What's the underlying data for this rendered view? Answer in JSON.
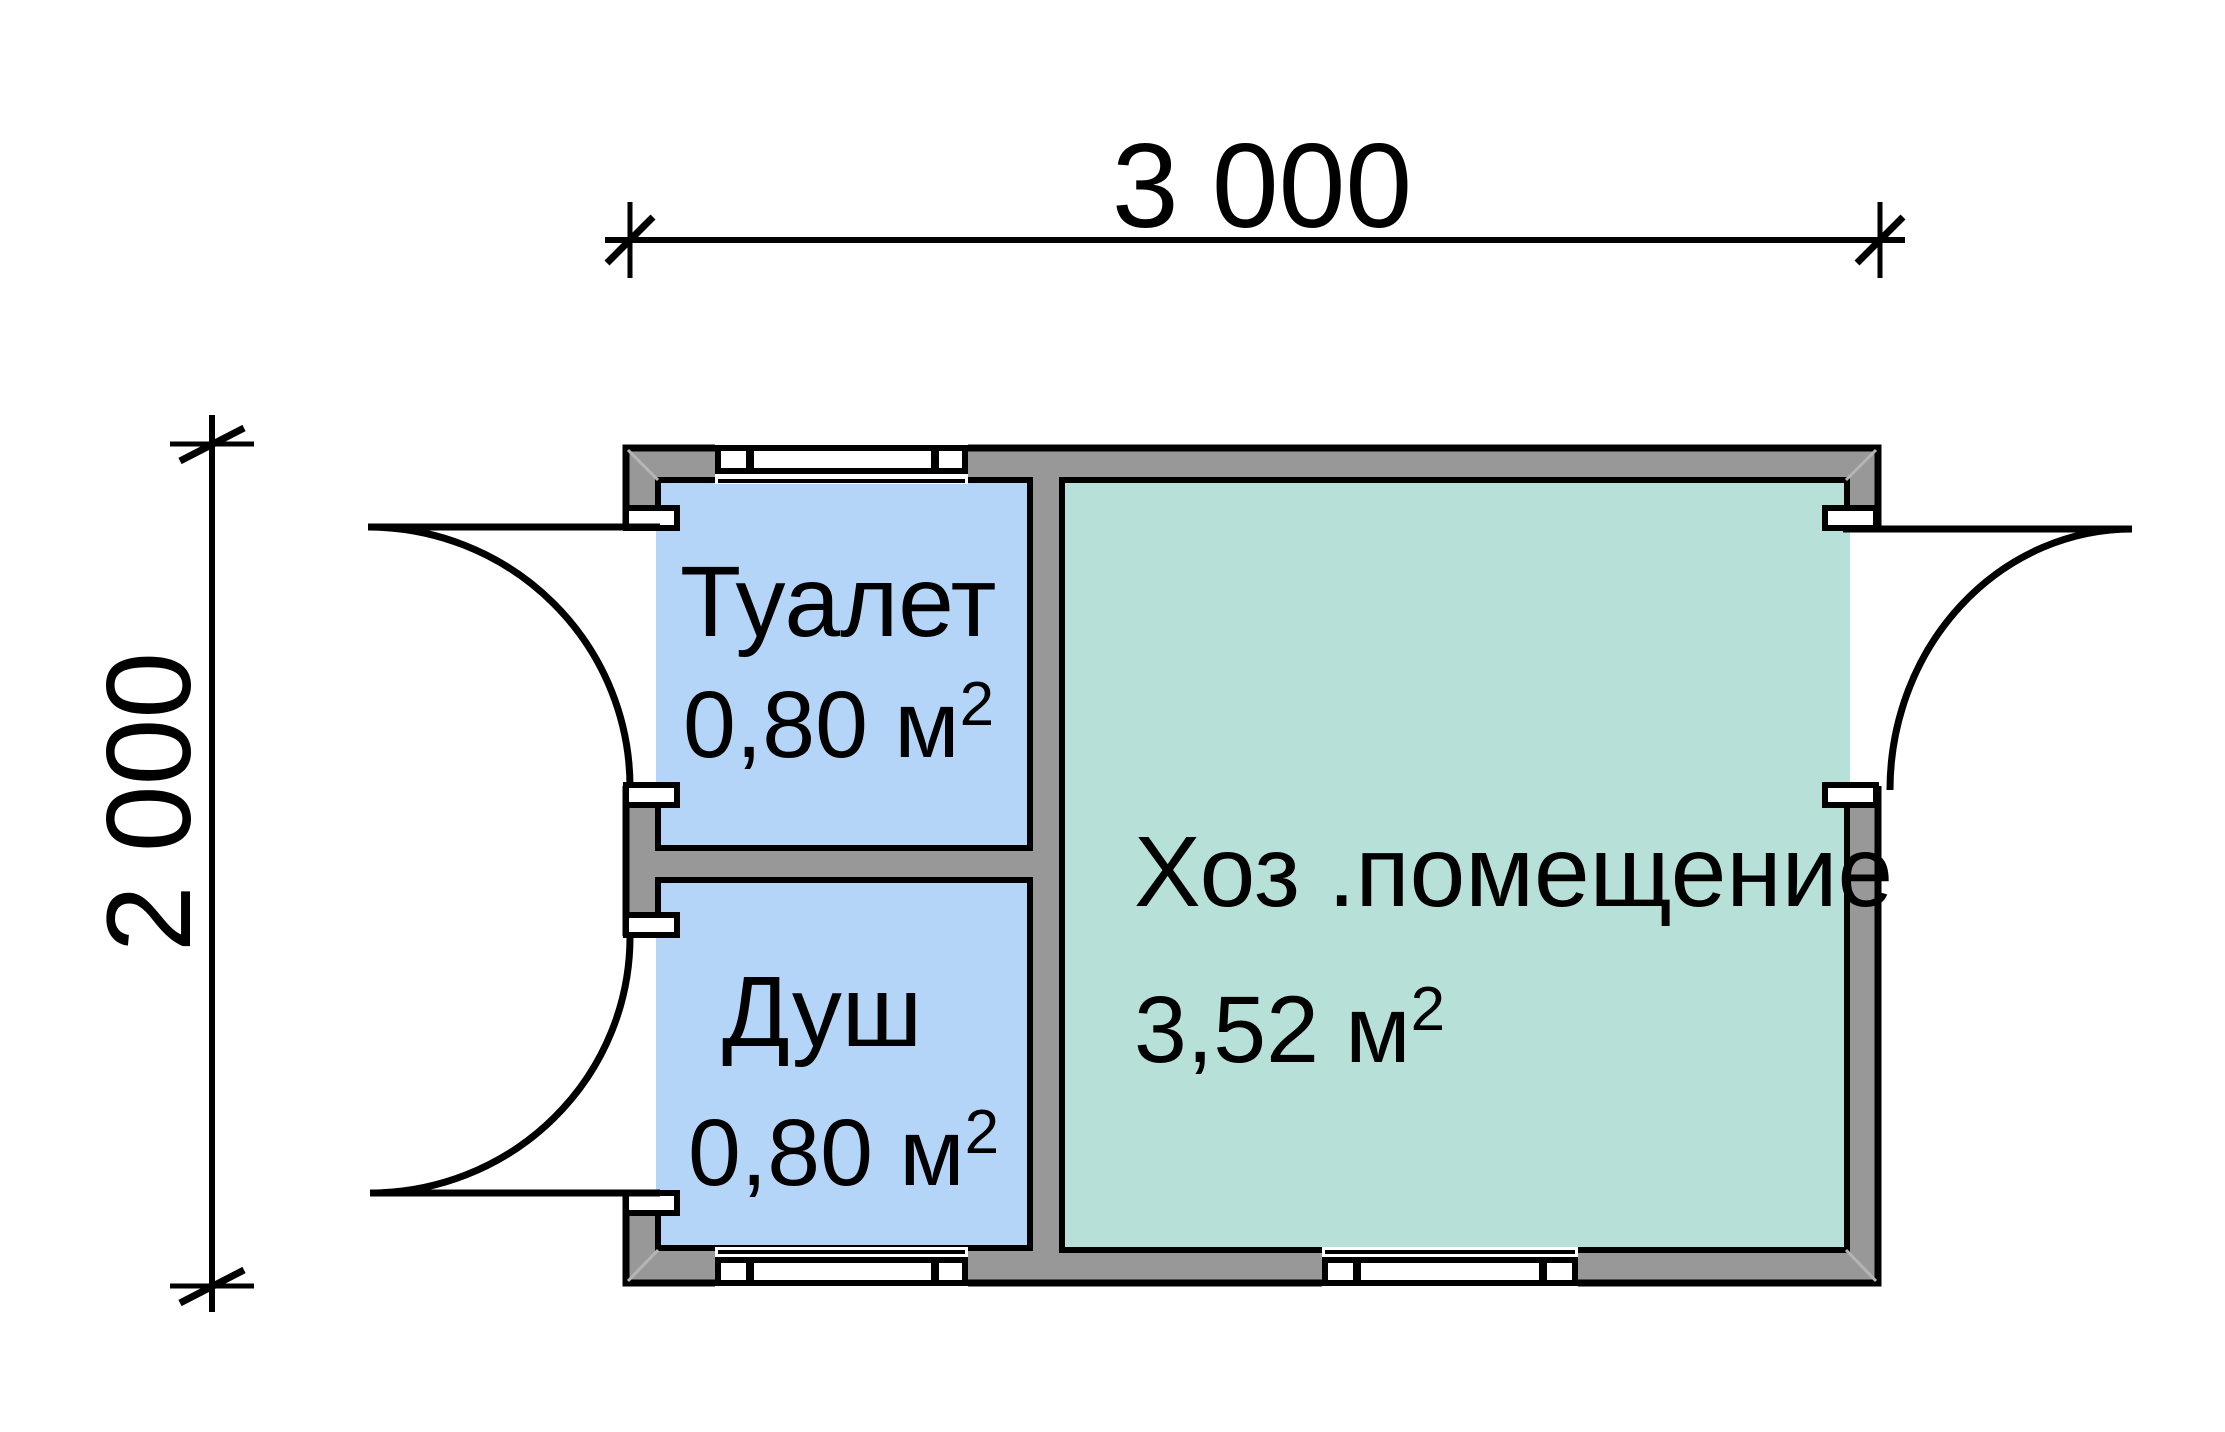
{
  "plan": {
    "dimensions": {
      "width_label": "3 000",
      "height_label": "2 000"
    },
    "rooms": {
      "toilet": {
        "name": "Туалет",
        "area_base": "0,80 м",
        "area_sup": "2",
        "area_full": "0,80 м²"
      },
      "shower": {
        "name": "Душ",
        "area_base": "0,80 м",
        "area_sup": "2",
        "area_full": "0,80 м²"
      },
      "utility": {
        "name": "Хоз .помещение",
        "area_base": "3,52 м",
        "area_sup": "2",
        "area_full": "3,52 м²"
      }
    },
    "colors": {
      "background": "#ffffff",
      "wall_fill": "#989898",
      "outline": "#000000",
      "wet_room_fill": "#b5d5f8",
      "utility_room_fill": "#b7e1d8"
    }
  }
}
